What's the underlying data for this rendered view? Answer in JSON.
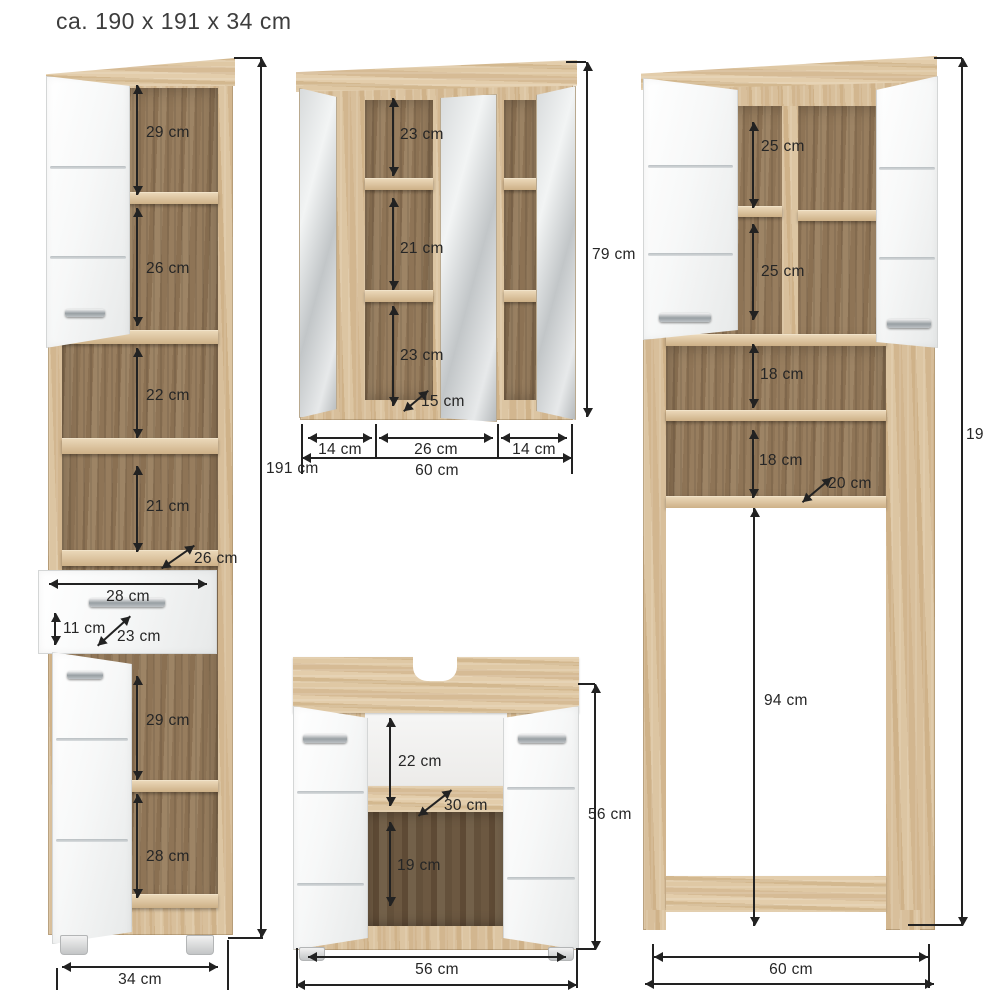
{
  "title": "ca. 190 x 191 x 34 cm",
  "palette": {
    "wood": "#d4b992",
    "wood_interior": "#8f7557",
    "wood_deep": "#64513b",
    "dimension_line": "#222222",
    "door_white": "#f4f5f5",
    "mirror_gray": "#d6d9da"
  },
  "dims": {
    "tall_cabinet": {
      "compartment_1": "29 cm",
      "compartment_2": "26 cm",
      "compartment_3": "22 cm",
      "compartment_4": "21 cm",
      "shelf_depth": "26 cm",
      "drawer_width": "28 cm",
      "drawer_height": "11 cm",
      "drawer_depth": "23 cm",
      "compartment_5": "29 cm",
      "compartment_6": "28 cm",
      "total_height": "191 cm",
      "total_width": "34 cm"
    },
    "mirror_cabinet": {
      "compartment_1": "23 cm",
      "compartment_2": "21 cm",
      "compartment_3": "23 cm",
      "shelf_depth": "15 cm",
      "width_left": "14 cm",
      "width_center": "26 cm",
      "width_right": "14 cm",
      "total_width": "60 cm",
      "total_height": "79 cm"
    },
    "sink_cabinet": {
      "compartment_1": "22 cm",
      "shelf_depth": "30 cm",
      "compartment_2": "19 cm",
      "total_width": "56 cm",
      "total_height": "56 cm"
    },
    "washer_cabinet": {
      "compartment_1": "25 cm",
      "compartment_2": "25 cm",
      "compartment_3": "18 cm",
      "compartment_4": "18 cm",
      "shelf_depth": "20 cm",
      "opening_height": "94 cm",
      "total_width": "60 cm",
      "total_height_partial": "19"
    }
  }
}
